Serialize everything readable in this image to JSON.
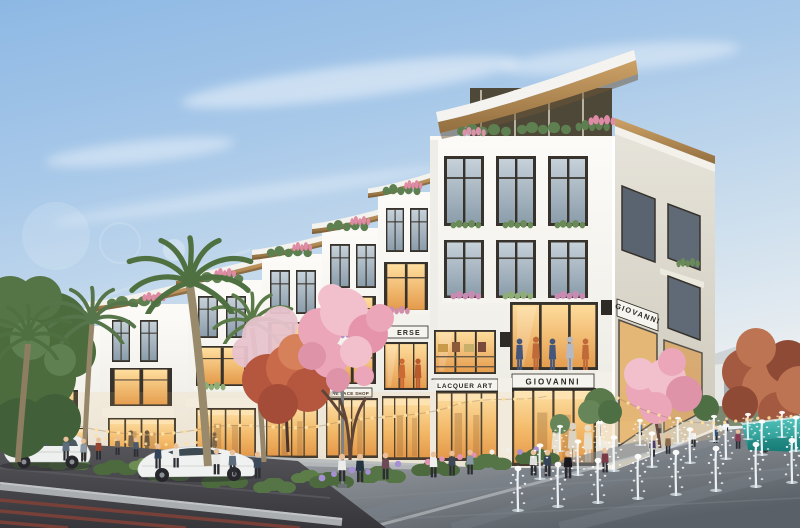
{
  "signs": {
    "corner_store_front": "GIOVANNI",
    "corner_store_side": "GIOVANNI",
    "lacquer_art_store": "LACQUER ART",
    "partial_store": "ERSE",
    "face_shop_a": "THE FACE SHOP",
    "face_shop_b": "THE FACE SHOP",
    "side_art": "ART"
  },
  "palette": {
    "sky_top": "#8db8e4",
    "sky_horizon": "#e9eef1",
    "facade_white": "#f7f6f2",
    "facade_shade": "#dddcd4",
    "side_wall": "#d6d1c4",
    "roof_wood": "#b88e57",
    "window_frame": "#37332c",
    "glass_cool": "#9cadbb",
    "glass_warm": "#f2bb6a",
    "storefront_glow": "#f6c878",
    "blossom_pink": "#eba6ba",
    "autumn_red": "#bd5c44",
    "palm_green": "#55744a",
    "hedge_green": "#4c6a3e",
    "road_asphalt": "#46464b",
    "bike_lane_red": "#7e4138",
    "curb_gray": "#a9adaf",
    "plaza_gray": "#8e9399",
    "pool_teal": "#2aa7a2",
    "string_light": "#ffdf9e",
    "flower_purple": "#a78fd4",
    "flower_pink": "#e292b4",
    "car_white": "#f0f2f1"
  }
}
